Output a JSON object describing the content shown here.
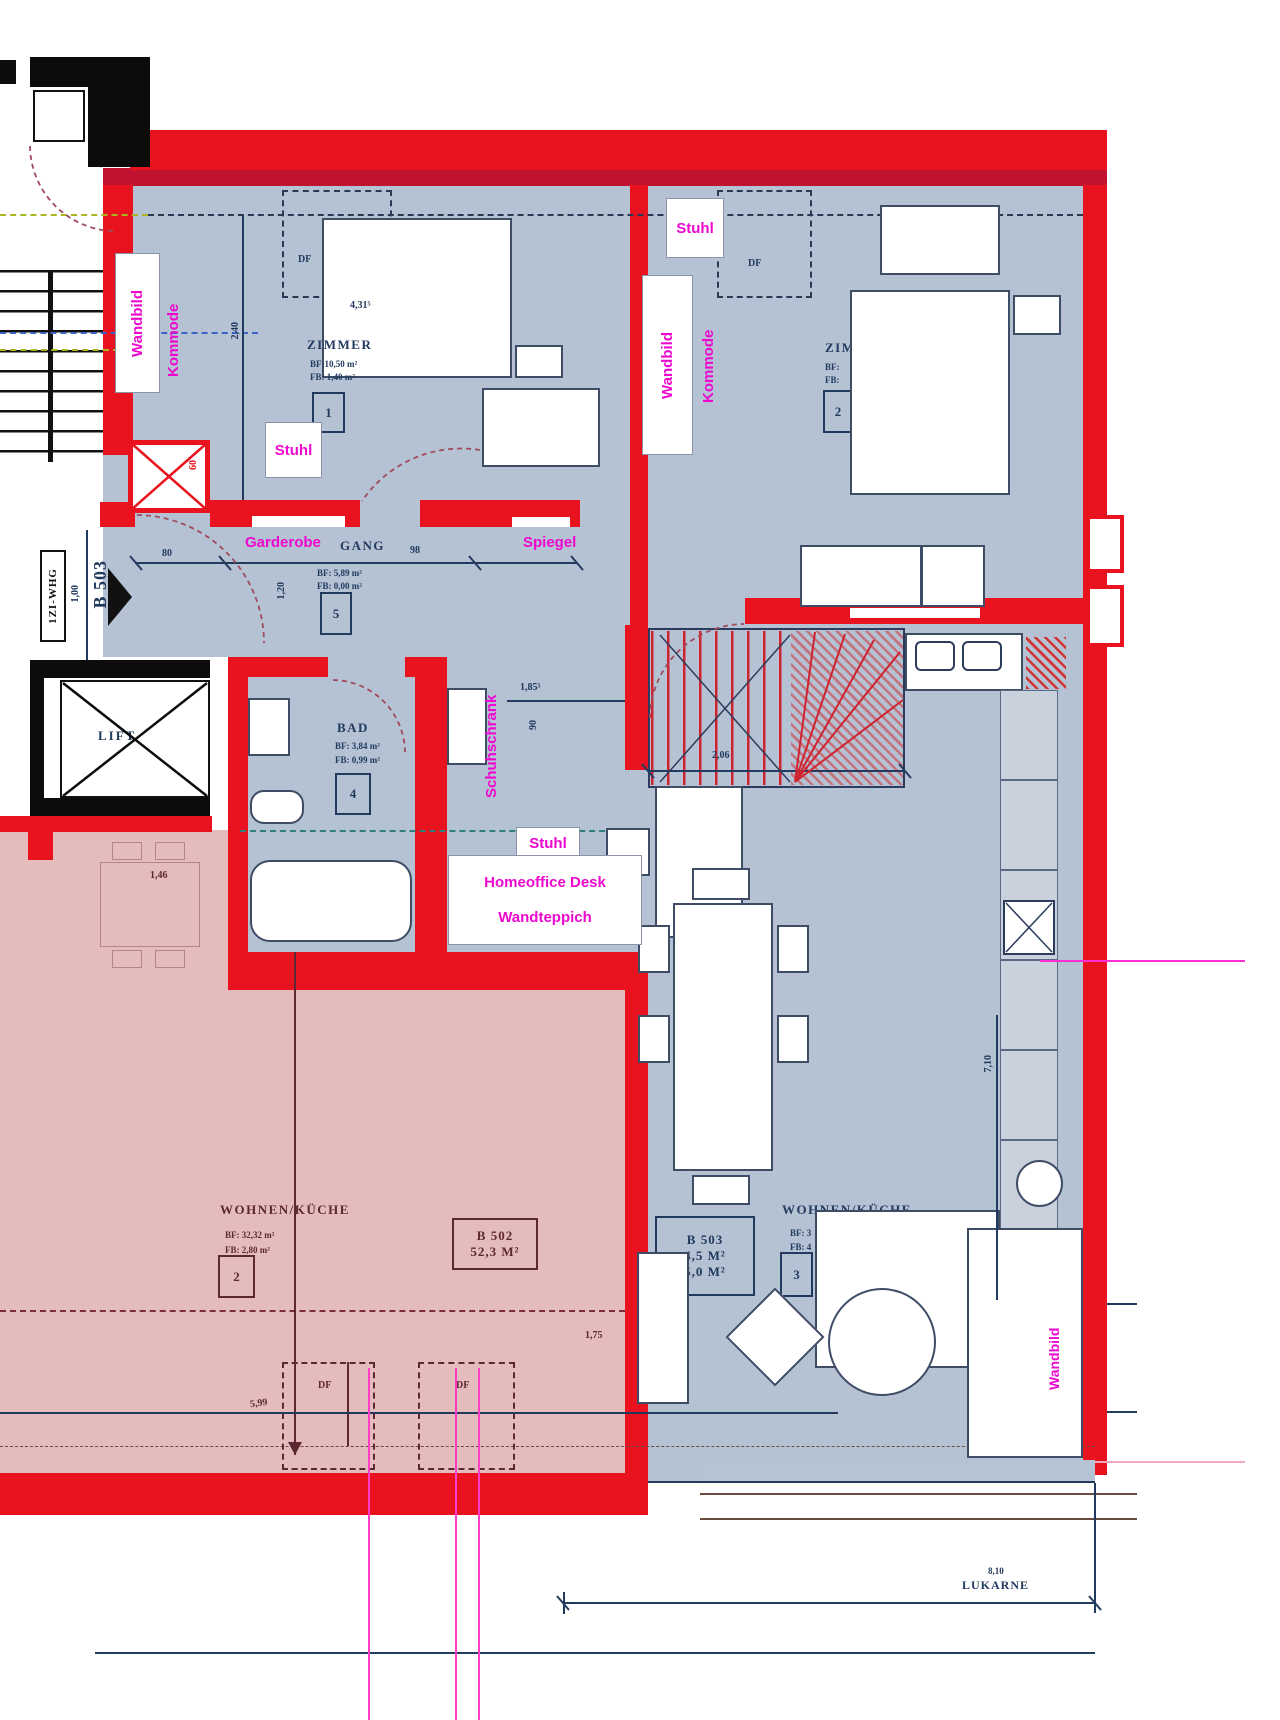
{
  "annotations": {
    "zimmer1_wandbild": "Wandbild",
    "zimmer1_kommode": "Kommode",
    "zimmer1_stuhl": "Stuhl",
    "zimmer2_stuhl": "Stuhl",
    "zimmer2_wandbild": "Wandbild",
    "zimmer2_kommode": "Kommode",
    "gang_garderobe": "Garderobe",
    "gang_spiegel": "Spiegel",
    "flur_schuhschrank": "Schuhschrank",
    "wohnen_stuhl": "Stuhl",
    "wohnen_homeoffice": "Homeoffice Desk",
    "wohnen_wandteppich": "Wandteppich",
    "wohnen_wandbild": "Wandbild"
  },
  "rooms": {
    "zimmer1": {
      "name": "ZIMMER",
      "area_bf": "BF:10,50 m²",
      "area_fb": "FB: 1,40 m²",
      "number": "1"
    },
    "zimmer2": {
      "name": "ZIMMER",
      "area_bf": "BF:",
      "area_fb": "FB:",
      "number": "2"
    },
    "gang": {
      "name": "GANG",
      "area_bf": "BF: 5,89 m²",
      "area_fb": "FB: 0,00 m²",
      "number": "5"
    },
    "bad": {
      "name": "BAD",
      "area_bf": "BF: 3,84 m²",
      "area_fb": "FB: 0,99 m²",
      "number": "4"
    },
    "wohnen_b502": {
      "name": "WOHNEN/KÜCHE",
      "area_bf": "BF: 32,32 m²",
      "area_fb": "FB: 2,80 m²",
      "number": "2"
    },
    "wohnen_b503": {
      "name": "WOHNEN/KÜCHE",
      "area_bf": "BF: 3",
      "area_fb": "FB: 4",
      "number": "3"
    },
    "lift": {
      "name": "LIFT"
    }
  },
  "apartments": {
    "b502_tag": {
      "id": "B 502",
      "area": "52,3 M²"
    },
    "b503_tag": {
      "id": "B 503",
      "area_line1": "4,5 M²",
      "area_line2": "5,0 M²"
    },
    "b503_entry": "B 503",
    "zi_whg": "1ZI-WHG"
  },
  "skylight": {
    "label": "DF"
  },
  "dimensions": {
    "bedroom1_width": "4,31⁵",
    "bedroom1_depth": "2,40",
    "gang_98": "98",
    "gang_80": "80",
    "gang_120": "1,20",
    "shaft_60": "60",
    "entry_100": "1,00",
    "flur_185": "1,85⁵",
    "flur_90": "90",
    "stairs_206": "2,06",
    "living_710": "7,10",
    "b502_599": "5,99",
    "b502_175": "1,75",
    "b502_146": "1,46",
    "lukarne_810": "8,10",
    "lukarne_label": "LUKARNE"
  }
}
